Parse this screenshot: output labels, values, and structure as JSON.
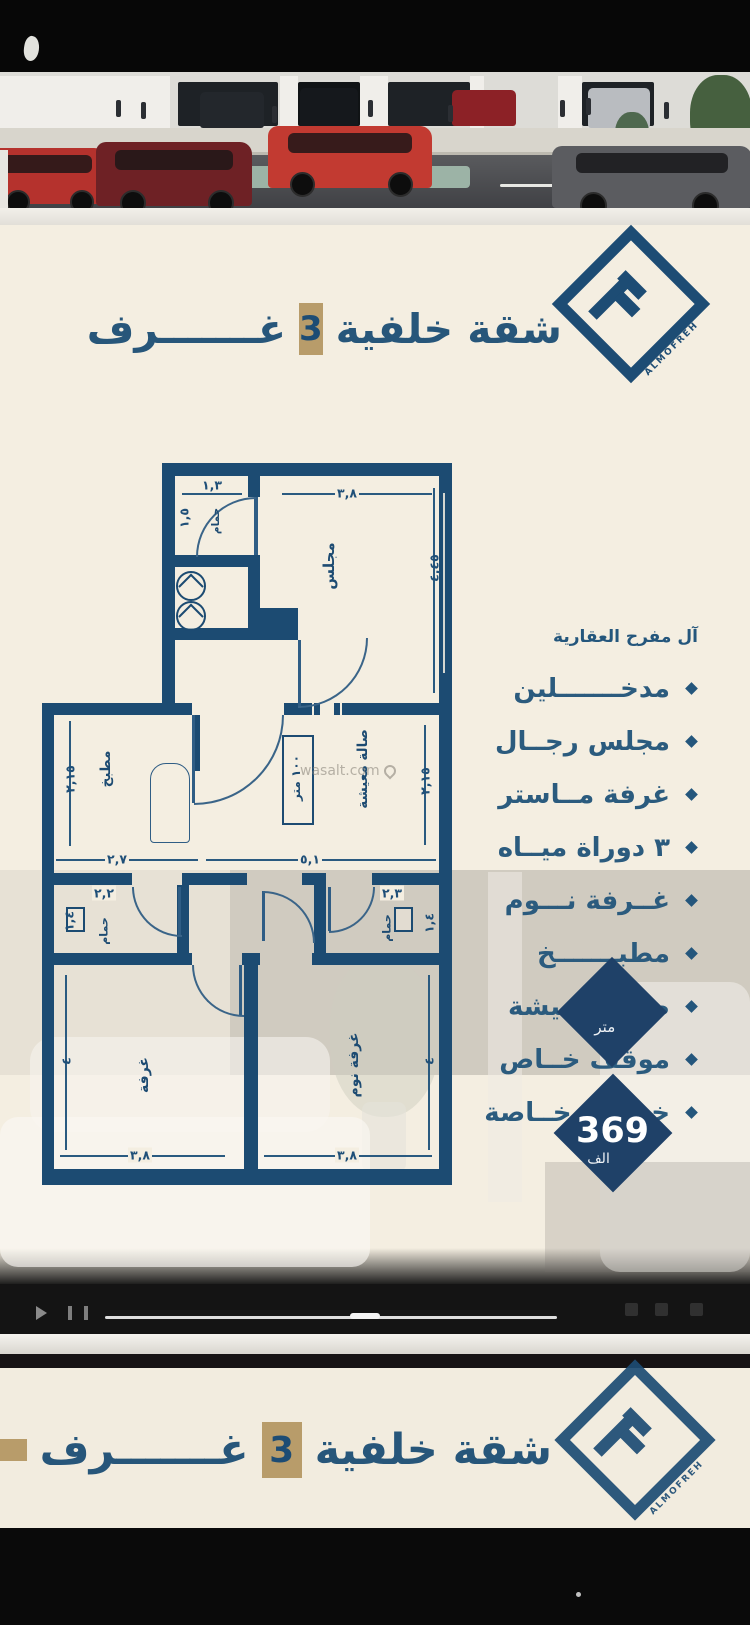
{
  "brand": {
    "logo_text": "ALMOFREH",
    "company_name": "آل مفرح العقارية"
  },
  "title": {
    "prefix": "شقة خلفية",
    "count": "3",
    "suffix": "غـــــــرف"
  },
  "features": [
    "مدخـــــــلين",
    "مجلس رجــال",
    "غرفة مــاستر",
    "٣ دوراة ميــاه",
    "غــرفة نـــوم",
    "مطبـــــــخ",
    "صالة معـيشة",
    "موقف خــاص",
    "خزانات خــاصة"
  ],
  "plan": {
    "labels": {
      "majlis": "مجلس",
      "kitchen": "مطبخ",
      "living": "صالة معيشة",
      "bathroom": "حمام",
      "room": "غرفة",
      "bedroom": "غرفة نوم",
      "area_box": "١٠٠ متر"
    },
    "dims": {
      "top_bath_w": "١,٣",
      "top_bath_h": "١,٥",
      "majlis_w": "٣,٨",
      "majlis_h": "٤,٤٥",
      "kitchen_w": "٢,٧",
      "kitchen_h": "٢,١٥",
      "living_w": "٥,١",
      "living_h": "٢,١٥",
      "bath_left_w": "٢,٢",
      "bath_left_h": "١,٤",
      "bath_right_w": "٢,٣",
      "bath_right_h": "١,٤",
      "room_left_w": "٣,٨",
      "room_left_h": "٤",
      "room_right_w": "٣,٨",
      "room_right_h": "٤"
    },
    "watermark": "wasalt.com"
  },
  "badges": {
    "area": {
      "unit": "متر"
    },
    "price": {
      "value": "369",
      "unit": "الف"
    }
  },
  "colors": {
    "navy": "#1d4c74",
    "tan": "#b89c6a",
    "cream": "#f4eee1",
    "badge_navy": "#1f4168",
    "wall": "#1c4b72"
  }
}
